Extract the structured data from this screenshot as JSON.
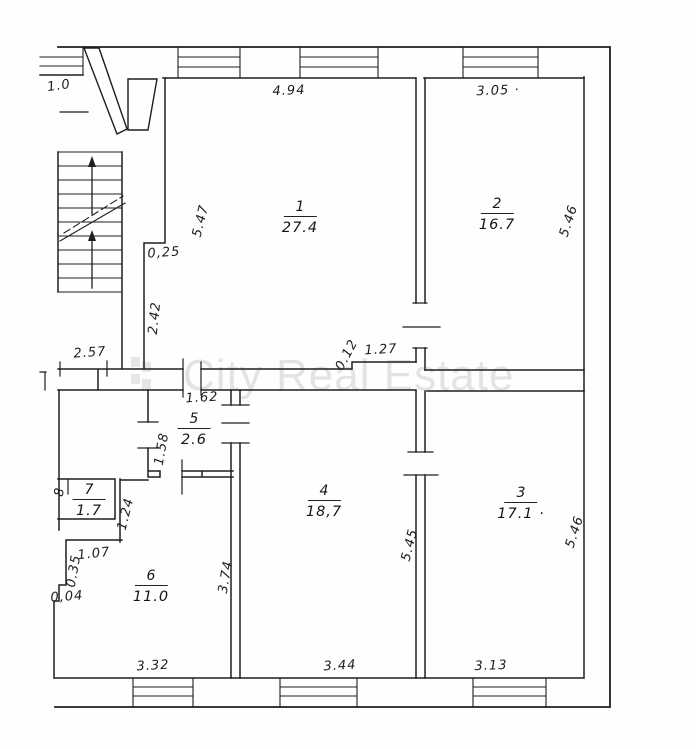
{
  "plan": {
    "title": "apartment-floor-plan",
    "watermark": "City Real Estate",
    "rooms": [
      {
        "number": "1",
        "area": "27.4",
        "x": 300,
        "y": 196
      },
      {
        "number": "2",
        "area": "16.7",
        "x": 497,
        "y": 193
      },
      {
        "number": "3",
        "area": "17.1 ·",
        "x": 521,
        "y": 482
      },
      {
        "number": "4",
        "area": "18,7",
        "x": 324,
        "y": 480
      },
      {
        "number": "5",
        "area": "2.6",
        "x": 194,
        "y": 408
      },
      {
        "number": "6",
        "area": "11.0",
        "x": 151,
        "y": 565
      },
      {
        "number": "7",
        "area": "1.7",
        "x": 89,
        "y": 479
      }
    ],
    "dimensions": [
      {
        "text": "4.94",
        "x": 289,
        "y": 91,
        "rot": -2
      },
      {
        "text": "3.05 ·",
        "x": 498,
        "y": 91,
        "rot": -2
      },
      {
        "text": "5.47",
        "x": 201,
        "y": 221,
        "rot": -76
      },
      {
        "text": "5.46",
        "x": 569,
        "y": 221,
        "rot": -72
      },
      {
        "text": "0,25",
        "x": 164,
        "y": 253,
        "rot": -4
      },
      {
        "text": "2.42",
        "x": 155,
        "y": 318,
        "rot": -84
      },
      {
        "text": "2.57",
        "x": 90,
        "y": 353,
        "rot": -4
      },
      {
        "text": "0.12",
        "x": 347,
        "y": 355,
        "rot": -62
      },
      {
        "text": "1.27",
        "x": 381,
        "y": 350,
        "rot": -3
      },
      {
        "text": "1.62",
        "x": 202,
        "y": 398,
        "rot": -3
      },
      {
        "text": "1.58",
        "x": 162,
        "y": 449,
        "rot": -80
      },
      {
        "text": "1.24",
        "x": 126,
        "y": 514,
        "rot": -76
      },
      {
        "text": "1.07",
        "x": 94,
        "y": 554,
        "rot": -6
      },
      {
        "text": "0.35",
        "x": 74,
        "y": 571,
        "rot": -80
      },
      {
        "text": "0,04",
        "x": 67,
        "y": 597,
        "rot": -4
      },
      {
        "text": "3.74",
        "x": 226,
        "y": 577,
        "rot": -80
      },
      {
        "text": "5.45",
        "x": 410,
        "y": 545,
        "rot": -76
      },
      {
        "text": "5.46",
        "x": 575,
        "y": 532,
        "rot": -72
      },
      {
        "text": "3.32",
        "x": 153,
        "y": 666,
        "rot": -3
      },
      {
        "text": "3.44",
        "x": 340,
        "y": 666,
        "rot": -3
      },
      {
        "text": "3.13",
        "x": 491,
        "y": 666,
        "rot": -2
      },
      {
        "text": "1.0",
        "x": 59,
        "y": 86,
        "rot": -8
      },
      {
        "text": "8",
        "x": 60,
        "y": 492,
        "rot": -80
      }
    ]
  }
}
